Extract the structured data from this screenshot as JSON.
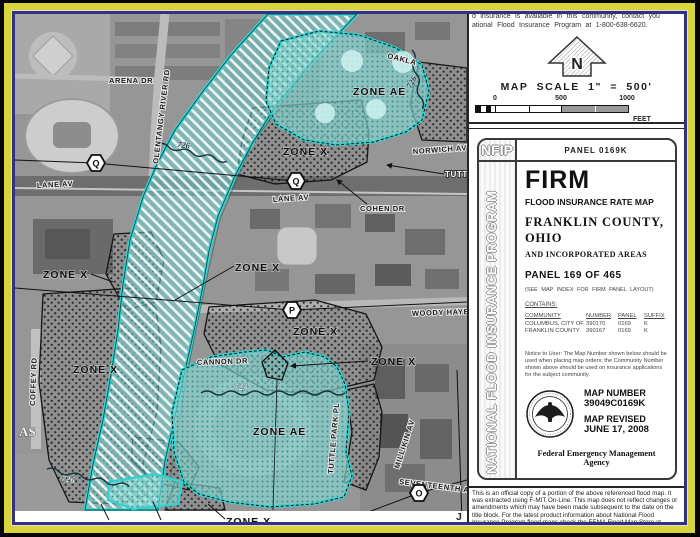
{
  "note_top": {
    "line1": "d insurance is available in this community, contact you",
    "line2": "ational Flood Insurance Program at 1-800-638-6620."
  },
  "scale": {
    "title": "MAP SCALE  1\" = 500'",
    "tick0": "0",
    "tick500": "500",
    "tick1000": "1000",
    "unit": "FEET",
    "north_letter": "N"
  },
  "nfip": {
    "logo": "NFIP",
    "vertical_title": "NATIONAL FLOOD INSURANCE PROGRAM",
    "panel_label": "PANEL 0169K",
    "title": "FIRM",
    "subtitle": "FLOOD INSURANCE RATE MAP",
    "region_line1": "FRANKLIN COUNTY,",
    "region_line2": "OHIO",
    "region_line3": "AND INCORPORATED AREAS",
    "panel_of": "PANEL 169 OF 465",
    "see_note": "(SEE MAP INDEX FOR FIRM PANEL LAYOUT)",
    "contains_label": "CONTAINS:",
    "table": {
      "headers": [
        "COMMUNITY",
        "NUMBER",
        "PANEL",
        "SUFFIX"
      ],
      "rows": [
        [
          "COLUMBUS, CITY OF",
          "390170",
          "0169",
          "K"
        ],
        [
          "FRANKLIN COUNTY",
          "390167",
          "0169",
          "K"
        ]
      ]
    },
    "notice": "Notice to User: The Map Number shown below should be used when placing map orders; the Community Number shown above should be used on insurance applications for the subject community.",
    "map_number_label": "MAP NUMBER",
    "map_number": "39049C0169K",
    "revised_label": "MAP REVISED",
    "revised_date": "JUNE 17, 2008",
    "agency": "Federal Emergency Management Agency"
  },
  "footer_note": "This is an official copy of a portion of the above referenced flood map.  It was extracted using F-MIT On-Line.  This map does not reflect changes or amendments which may have been made subsequent to the date on the title block.  For the latest product information about National Flood Insurance Program flood maps check the FEMA Flood Map Store at www.msc.fema.gov",
  "map": {
    "colors": {
      "frame_yellow": "#d8d43c",
      "frame_navy": "#32327e",
      "floodway_cyan": "#3bd4d2",
      "zone_ae_fill": "#89d8d3"
    },
    "labels": {
      "oakland": "OAKLA",
      "arena_dr": "ARENA DR",
      "olentangy": "OLENTANGY RIVER RD",
      "norwich": "NORWICH AV",
      "lane_av_w": "LANE AV",
      "lane_av_e": "LANE AV",
      "cohen_dr": "COHEN DR",
      "tuttle_cut": "TUTTL",
      "woody_hayes": "WOODY HAYE",
      "cannon_dr": "CANNON DR",
      "tuttle_park": "TUTTLE PARK PL",
      "millikin": "MILLIKIN AV",
      "seventeenth": "SEVENTEENTH A",
      "coffey_rd": "COFFEY RD",
      "as_cut": "AS",
      "j_cut": "J",
      "zone_ae_top": "ZONE AE",
      "zone_ae_bottom": "ZONE AE",
      "zone_x_top": "ZONE X",
      "zone_x_left": "ZONE X",
      "zone_x_mid": "ZONE X",
      "zone_x_stipple": "ZONE X",
      "zone_x_island": "ZONE X",
      "zone_x_sw": "ZONE X",
      "zone_x_bottom": "ZONE X",
      "bfe_726_a": "726",
      "bfe_726_b": "726",
      "bfe_726_c": "726",
      "bfe_725": "725"
    },
    "markers": {
      "q1": "Q",
      "q2": "Q",
      "p": "P",
      "o": "O"
    }
  }
}
